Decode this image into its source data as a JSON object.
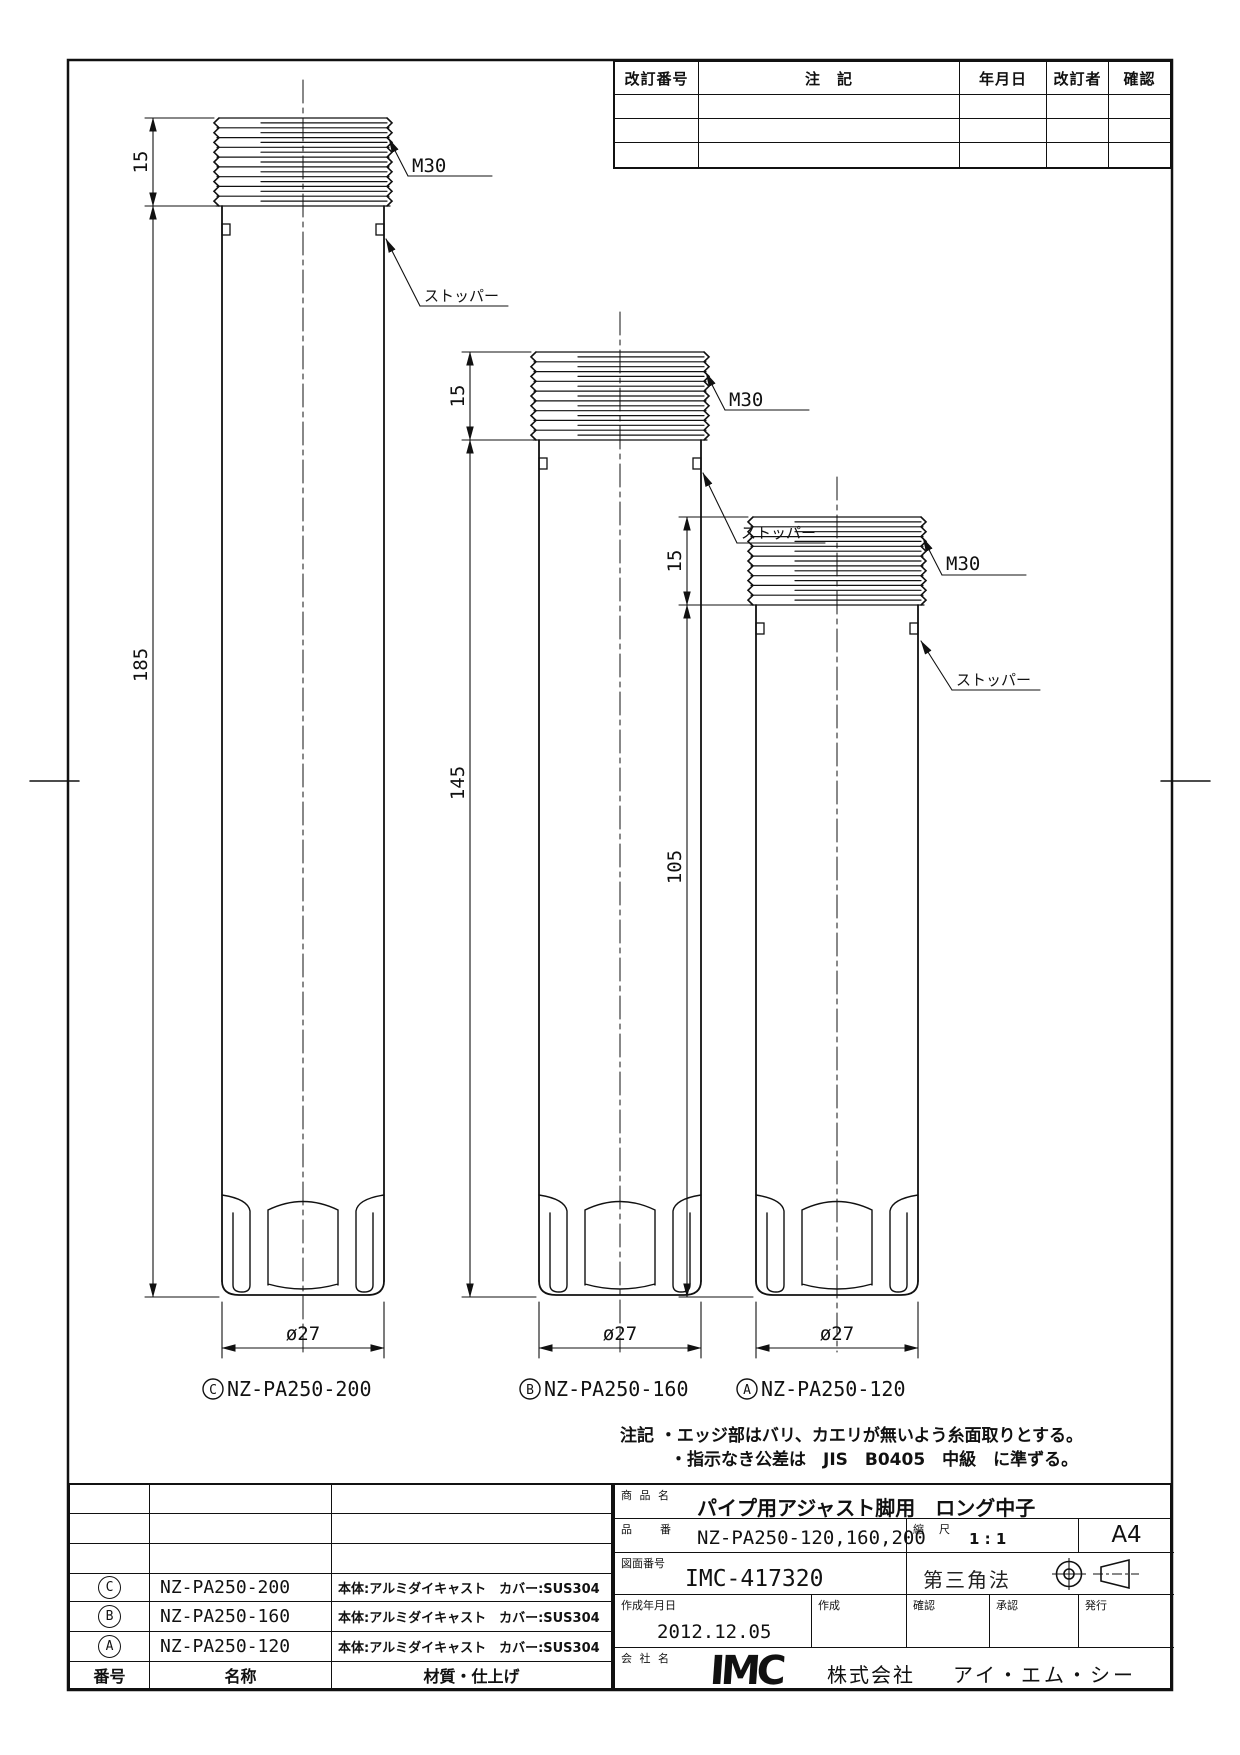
{
  "revision_table": {
    "headers": [
      "改訂番号",
      "注　記",
      "年月日",
      "改訂者",
      "確認"
    ]
  },
  "drawing_notes": {
    "title": "注記",
    "lines": [
      "・エッジ部はバリ、カエリが無いよう糸面取りとする。",
      "・指示なき公差は　JIS　B0405　中級　に準ずる。"
    ]
  },
  "cylinders": [
    {
      "id": "C",
      "part_no": "NZ-PA250-200",
      "thread_len": "15",
      "length": "185",
      "diameter": "ø27",
      "thread_spec": "M30",
      "stopper": "ストッパー"
    },
    {
      "id": "B",
      "part_no": "NZ-PA250-160",
      "thread_len": "15",
      "length": "145",
      "diameter": "ø27",
      "thread_spec": "M30",
      "stopper": "ストッパー"
    },
    {
      "id": "A",
      "part_no": "NZ-PA250-120",
      "thread_len": "15",
      "length": "105",
      "diameter": "ø27",
      "thread_spec": "M30",
      "stopper": "ストッパー"
    }
  ],
  "parts_table": {
    "rows": [
      {
        "no": "C",
        "name": "NZ-PA250-200",
        "material": "本体:アルミダイキャスト　カバー:SUS304"
      },
      {
        "no": "B",
        "name": "NZ-PA250-160",
        "material": "本体:アルミダイキャスト　カバー:SUS304"
      },
      {
        "no": "A",
        "name": "NZ-PA250-120",
        "material": "本体:アルミダイキャスト　カバー:SUS304"
      }
    ],
    "footer": {
      "no": "番号",
      "name": "名称",
      "material": "材質・仕上げ"
    }
  },
  "title_block": {
    "product_label": "商 品 名",
    "product_name": "パイプ用アジャスト脚用　ロング中子",
    "part_no_label": "品　　番",
    "part_no": "NZ-PA250-120,160,200",
    "scale_label": "縮　尺",
    "scale": "1 : 1",
    "paper_size": "A4",
    "drawing_no_label": "図面番号",
    "drawing_no": "IMC-417320",
    "projection": "第三角法",
    "date_label": "作成年月日",
    "date": "2012.12.05",
    "created_label": "作成",
    "checked_label": "確認",
    "approved_label": "承認",
    "issued_label": "発行",
    "company_label": "会 社 名",
    "logo": "IMC",
    "company_type": "株式会社",
    "company_name": "アイ・エム・シー"
  }
}
